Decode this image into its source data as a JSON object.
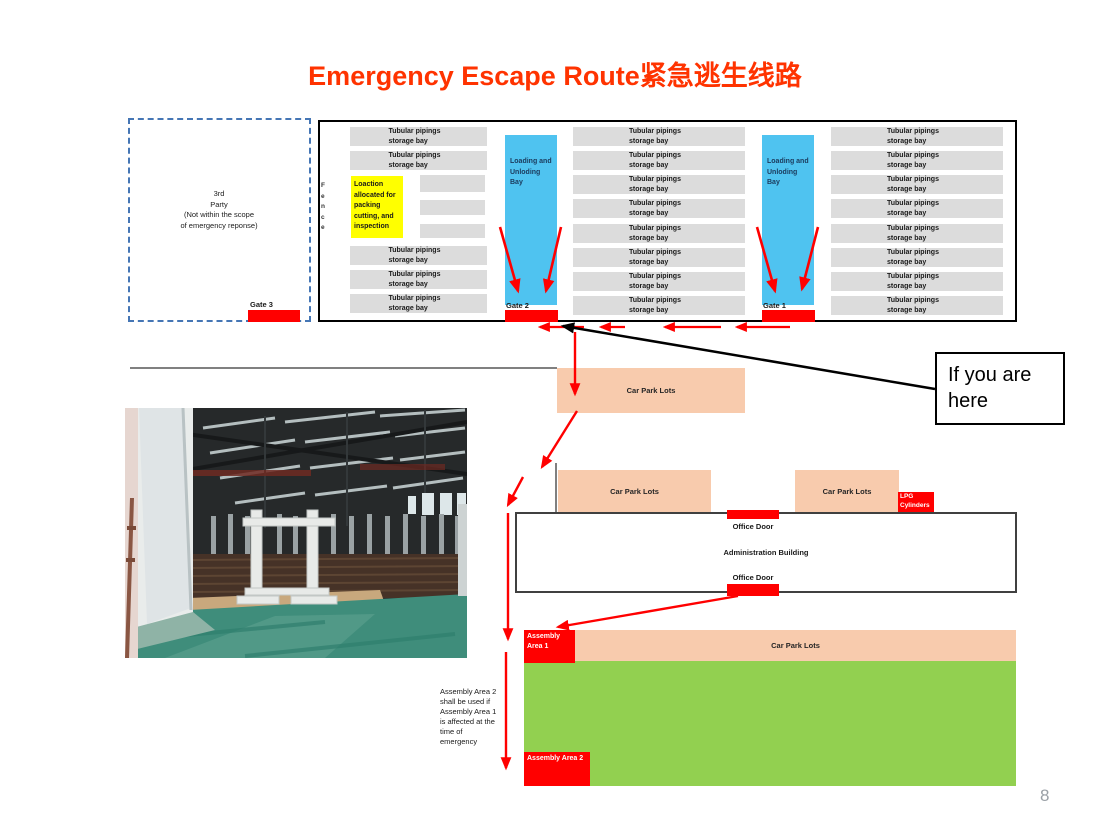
{
  "slide": {
    "title": "Emergency Escape Route紧急逃生线路",
    "page_number": "8"
  },
  "colors": {
    "title_red": "#FF3300",
    "marker_red": "#FF0000",
    "bay_blue": "#4FC3F0",
    "storage_gray": "#DCDCDC",
    "car_park_peach": "#F8CBAD",
    "assembly_green": "#92D050",
    "note_yellow": "#FFFF00",
    "fence_dash_blue": "#4576B5"
  },
  "top_plan": {
    "third_party_note": "3rd\nParty\n(Not within the scope\nof emergency reponse)",
    "fence_label": "F\ne\nn\nc\ne",
    "storage_bay_label": "Tubular pipings storage bay",
    "yellow_note": "Loaction allocated for packing cutting, and inspection",
    "loading_bay_label": "Loading and Unloding Bay",
    "gate1_label": "Gate 1",
    "gate2_label": "Gate 2",
    "gate3_label": "Gate 3"
  },
  "site": {
    "car_park_label": "Car Park Lots",
    "lpg_label": "LPG Cylinders",
    "office_door_label": "Office Door",
    "admin_label": "Administration Building",
    "assembly_area1_label": "Assembly Area 1",
    "assembly_area2_label": "Assembly Area 2",
    "assembly_note": "Assembly Area 2\nshall be used if\nAssembly Area 1\nis affected at the\ntime of\nemergency",
    "you_are_here_label": "If you are here"
  }
}
